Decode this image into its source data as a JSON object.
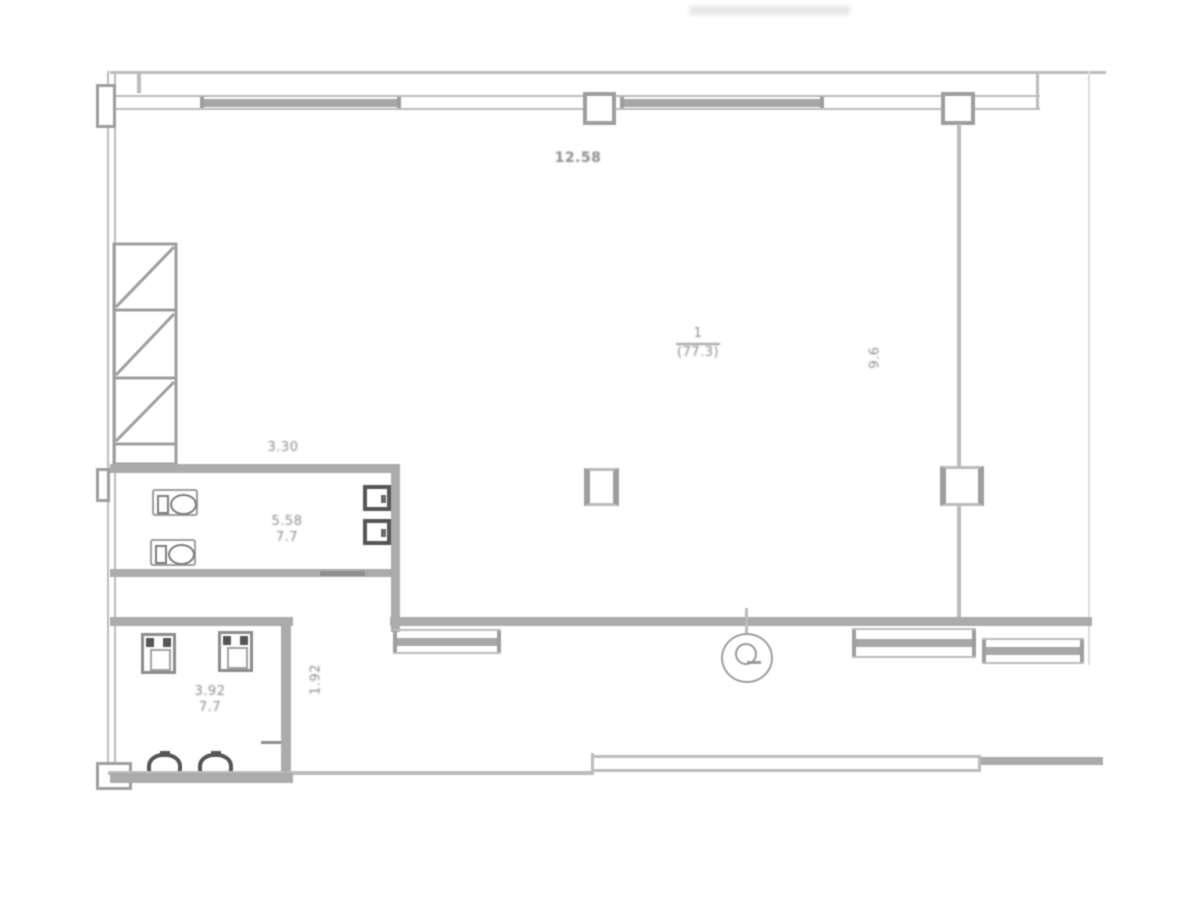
{
  "labels": {
    "top_width": "12.58",
    "hall_number": "1",
    "hall_area": "(77.3)",
    "hall_depth": "9.6",
    "corridor_width": "3.30",
    "wc_upper_width": "5.58",
    "wc_upper_area": "7.7",
    "wc_lower_width": "3.92",
    "wc_lower_area": "7.7",
    "wc_lower_depth": "1.92"
  },
  "colors": {
    "paper": "#ffffff",
    "line": "#bcbcbc",
    "line-strong": "#9e9e9e",
    "wall": "#ababab",
    "fixture-dark": "#565656",
    "text": "#8d8d8d"
  }
}
